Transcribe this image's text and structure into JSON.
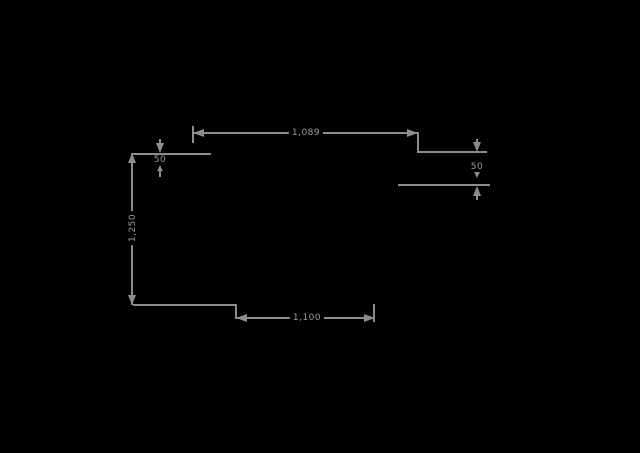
{
  "colors": {
    "background": "#000000",
    "line": "#8c8c8c",
    "text": "#9c9c9c"
  },
  "drawing": {
    "title": "dimension-drawing",
    "dimensions": {
      "top_width": {
        "label": "1,089"
      },
      "left_height": {
        "label": "1,250"
      },
      "bottom_width": {
        "label": "1,100"
      },
      "left_offset": {
        "label": "50"
      },
      "right_offset": {
        "label": "50"
      }
    }
  }
}
